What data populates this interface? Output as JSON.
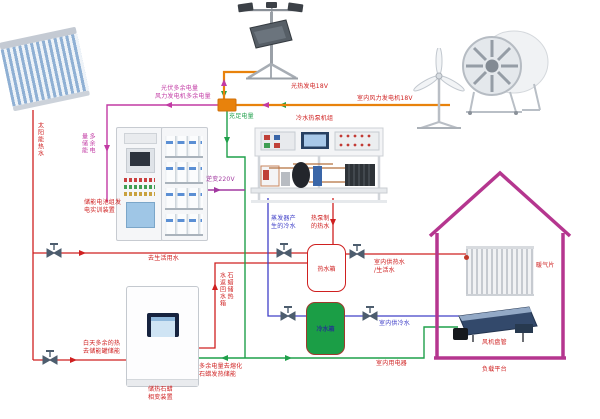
{
  "diagram_title_note": "multi-energy (solar / wind / heat-pump / storage) training system schematic",
  "colors": {
    "hot_water_line": "#cf2020",
    "surplus_power_line": "#c23aa4",
    "generation_line": "#e8820c",
    "sufficient_power_line": "#1fa04a",
    "cold_water_line": "#4040c8",
    "inverter_line": "#a238a0",
    "house_outline": "#b5368f",
    "cold_tank_fill": "#1b9e46"
  },
  "icons": {
    "valve-icon": "gate-valve bowtie with T-handle",
    "flow-arrow-icon": "small solid triangle showing flow direction"
  },
  "labels": {
    "solar_hot_water": "太阳能热水",
    "pv_surplus": "光伏多余电量",
    "wind_surplus": "风力发电机多余电量",
    "surplus_to_storage": "多余电\n量储能",
    "pv_generation": "光热发电18V",
    "wind_generation": "室内风力发电机18V",
    "sufficient_power": "充足电量",
    "inverter": "逆变220V",
    "storage_device": "储能电池组发\n电实训装置",
    "heat_pump_unit": "冷水热泵机组",
    "evaporator_cold": "蒸发器产\n生的冷水",
    "heat_pump_hot": "热泵制\n的热水",
    "hot_water_tank": "热水箱",
    "cold_water_tank": "冷水箱",
    "to_domestic_water": "去生活用水",
    "day_surplus_heat": "白天多余的热\n去储能罐储能",
    "paraffin_device": "储热石蜡\n相变装置",
    "paraffin_return": "石蜡储热\n水返回水箱",
    "surplus_melt_paraffin": "多余电量去熔化\n石蜡发热储能",
    "indoor_electricity": "室内用电器",
    "indoor_cold_water": "室内供冷水",
    "indoor_hot_water": "室内供热水\n/生活水",
    "radiator": "暖气片",
    "fan_coil": "风机盘管",
    "load_platform": "负载平台"
  }
}
